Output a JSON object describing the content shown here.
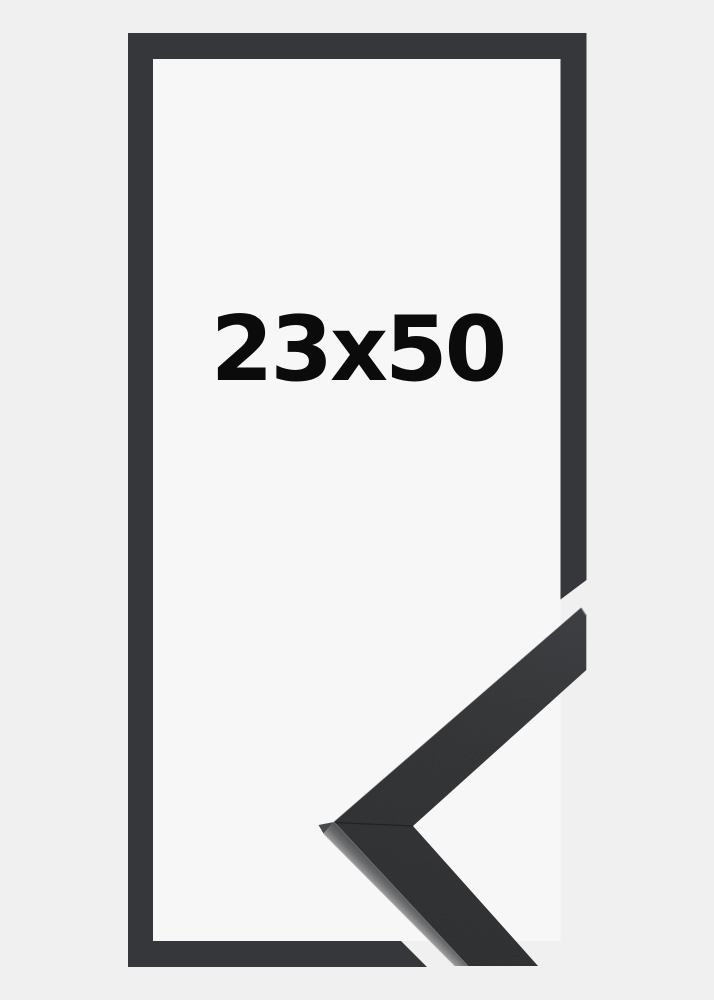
{
  "product": {
    "size_label": "23x50"
  },
  "colors": {
    "background": "#f0f0f1",
    "opening": "#f7f7f8",
    "frame": "#35373a",
    "label": "#0b0b0c",
    "corner_face": "#2d2e30",
    "corner_facet": "#67686a",
    "corner_edge_highlight": "#a7a8aa"
  }
}
